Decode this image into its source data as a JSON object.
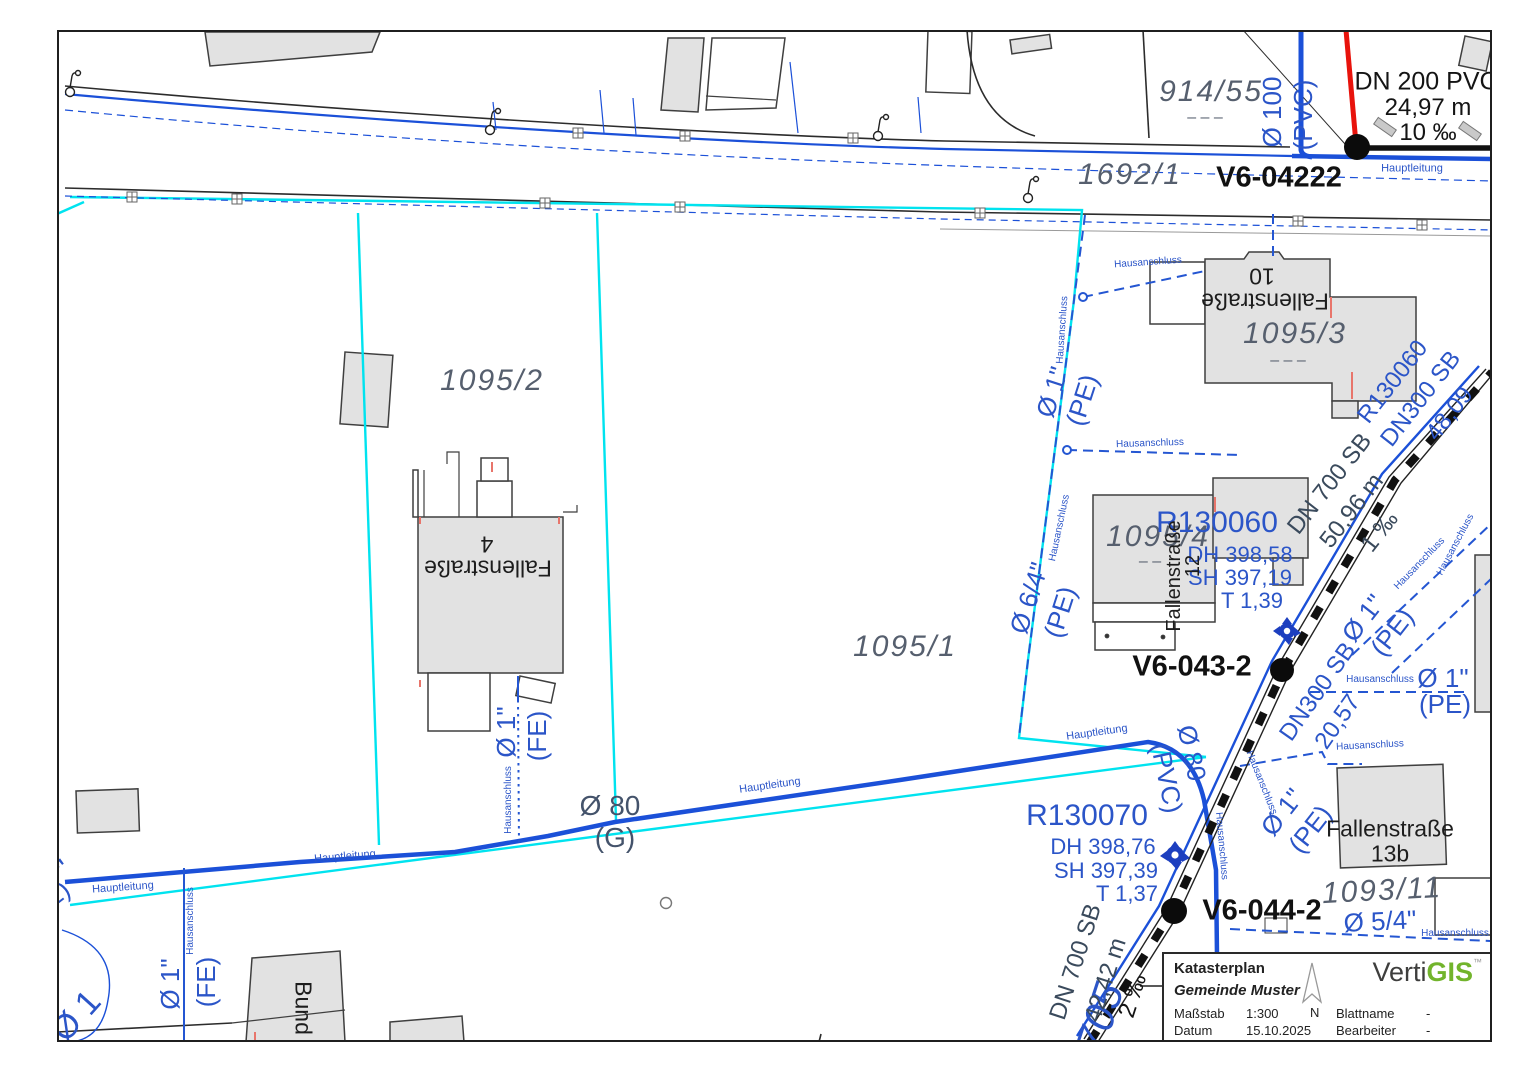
{
  "colors": {
    "water_blue": "#1b50d8",
    "label_blue": "#2b55c8",
    "boundary_cyan": "#00e3ef",
    "parcel_gray": "#565f6e",
    "sewer_label": "#3a4a5c",
    "red_accent": "#e8130c",
    "building_fill": "#e2e2e2",
    "logo_green": "#72b42c"
  },
  "legend": {
    "title": "Katasterplan",
    "municipality": "Gemeinde Muster",
    "scale_label": "Maßstab",
    "scale_value": "1:300",
    "date_label": "Datum",
    "date_value": "15.10.2025",
    "sheet_label": "Blattname",
    "sheet_value": "-",
    "editor_label": "Bearbeiter",
    "editor_value": "-",
    "north_label": "N",
    "logo": {
      "part1": "Verti",
      "part2": "GIS",
      "tm": "™"
    }
  },
  "map": {
    "labels": [
      {
        "n": "parcel-914-55",
        "t": "914/55",
        "x": 1211,
        "y": 92,
        "s": 30,
        "c": "#565f6e",
        "i": 1,
        "sp": 2
      },
      {
        "n": "parcel-914-55-dashes",
        "t": "– – –",
        "x": 1205,
        "y": 118,
        "s": 16,
        "c": "#565f6e"
      },
      {
        "n": "parcel-1692-1",
        "t": "1692/1",
        "x": 1130,
        "y": 175,
        "s": 30,
        "c": "#565f6e",
        "i": 1,
        "sp": 2
      },
      {
        "n": "parcel-1095-2",
        "t": "1095/2",
        "x": 492,
        "y": 381,
        "s": 30,
        "c": "#565f6e",
        "i": 1,
        "sp": 2
      },
      {
        "n": "parcel-1095-1",
        "t": "1095/1",
        "x": 905,
        "y": 647,
        "s": 30,
        "c": "#565f6e",
        "i": 1,
        "sp": 2
      },
      {
        "n": "parcel-1095-3",
        "t": "1095/3",
        "x": 1295,
        "y": 334,
        "s": 30,
        "c": "#565f6e",
        "i": 1,
        "sp": 2
      },
      {
        "n": "parcel-1095-3-dashes",
        "t": "– – –",
        "x": 1288,
        "y": 361,
        "s": 16,
        "c": "#565f6e"
      },
      {
        "n": "parcel-1095-4",
        "t": "1095/4",
        "x": 1158,
        "y": 537,
        "s": 30,
        "c": "#565f6e",
        "i": 1,
        "sp": 2
      },
      {
        "n": "parcel-1095-4-dash",
        "t": "– –",
        "x": 1150,
        "y": 562,
        "s": 16,
        "c": "#565f6e"
      },
      {
        "n": "parcel-1093-11",
        "t": "1093/11",
        "x": 1382,
        "y": 891,
        "s": 30,
        "c": "#565f6e",
        "i": 1,
        "sp": 2,
        "r": -3
      },
      {
        "n": "parcel-705",
        "t": "705",
        "x": 1100,
        "y": 1018,
        "s": 42,
        "c": "#2b55c8",
        "i": 1,
        "r": -72
      },
      {
        "n": "node-v6-04222",
        "t": "V6-04222",
        "x": 1279,
        "y": 178,
        "s": 29,
        "c": "#111111",
        "b": 1
      },
      {
        "n": "node-v6-043-2",
        "t": "V6-043-2",
        "x": 1192,
        "y": 667,
        "s": 29,
        "c": "#111111",
        "b": 1
      },
      {
        "n": "node-v6-044-2",
        "t": "V6-044-2",
        "x": 1262,
        "y": 911,
        "s": 29,
        "c": "#111111",
        "b": 1
      },
      {
        "n": "pipe-dn200-material",
        "t": "DN 200 PVC",
        "x": 1426,
        "y": 82,
        "s": 25,
        "c": "#141414"
      },
      {
        "n": "pipe-dn200-length",
        "t": "24,97 m",
        "x": 1428,
        "y": 108,
        "s": 24,
        "c": "#141414"
      },
      {
        "n": "pipe-dn200-slope",
        "t": "10 ‰",
        "x": 1428,
        "y": 133,
        "s": 24,
        "c": "#141414"
      },
      {
        "n": "hauptleitung-top",
        "t": "Hauptleitung",
        "x": 1412,
        "y": 169,
        "s": 11,
        "c": "#2b55c8"
      },
      {
        "n": "pipe-dia-100",
        "t": "Ø 100",
        "x": 1272,
        "y": 112,
        "s": 26,
        "c": "#2b55c8",
        "r": -90
      },
      {
        "n": "pipe-dia-100-mat",
        "t": "(PVC)",
        "x": 1303,
        "y": 115,
        "s": 26,
        "c": "#2b55c8",
        "r": -90
      },
      {
        "n": "shaft-r130060",
        "t": "R130060",
        "x": 1217,
        "y": 523,
        "s": 30,
        "c": "#2b55c8"
      },
      {
        "n": "shaft-r130060-dh",
        "t": "DH 398,58",
        "x": 1240,
        "y": 555,
        "s": 22,
        "c": "#2b55c8"
      },
      {
        "n": "shaft-r130060-sh",
        "t": "SH 397,19",
        "x": 1240,
        "y": 578,
        "s": 22,
        "c": "#2b55c8"
      },
      {
        "n": "shaft-r130060-t",
        "t": "T 1,39",
        "x": 1252,
        "y": 601,
        "s": 22,
        "c": "#2b55c8"
      },
      {
        "n": "shaft-r130070",
        "t": "R130070",
        "x": 1087,
        "y": 816,
        "s": 30,
        "c": "#2b55c8"
      },
      {
        "n": "shaft-r130070-dh",
        "t": "DH 398,76",
        "x": 1103,
        "y": 847,
        "s": 22,
        "c": "#2b55c8"
      },
      {
        "n": "shaft-r130070-sh",
        "t": "SH 397,39",
        "x": 1106,
        "y": 871,
        "s": 22,
        "c": "#2b55c8"
      },
      {
        "n": "shaft-r130070-t",
        "t": "T 1,37",
        "x": 1127,
        "y": 894,
        "s": 22,
        "c": "#2b55c8"
      },
      {
        "n": "sewer-dn700-upper",
        "t": "DN 700 SB",
        "x": 1330,
        "y": 484,
        "s": 24,
        "c": "#3a4a5c",
        "r": -52
      },
      {
        "n": "sewer-dn700-upper-length",
        "t": "50,96 m",
        "x": 1352,
        "y": 511,
        "s": 24,
        "c": "#3a4a5c",
        "r": -52
      },
      {
        "n": "sewer-dn700-upper-slope",
        "t": "1 ‰",
        "x": 1380,
        "y": 532,
        "s": 24,
        "c": "#3a4a5c",
        "r": -52
      },
      {
        "n": "water-r130060-rot",
        "t": "R130060",
        "x": 1393,
        "y": 382,
        "s": 24,
        "c": "#2b55c8",
        "r": -52
      },
      {
        "n": "water-dn300-upper",
        "t": "DN300 SB",
        "x": 1421,
        "y": 399,
        "s": 24,
        "c": "#2b55c8",
        "r": -52
      },
      {
        "n": "water-dn300-upper-length",
        "t": "48,09",
        "x": 1450,
        "y": 414,
        "s": 24,
        "c": "#2b55c8",
        "r": -52
      },
      {
        "n": "water-dn300-lower",
        "t": "DN300 SB",
        "x": 1318,
        "y": 692,
        "s": 24,
        "c": "#2b55c8",
        "r": -55
      },
      {
        "n": "water-dn300-lower-length",
        "t": "20,57",
        "x": 1338,
        "y": 722,
        "s": 24,
        "c": "#2b55c8",
        "r": -55
      },
      {
        "n": "sewer-dn700-lower",
        "t": "DN 700 SB",
        "x": 1076,
        "y": 962,
        "s": 24,
        "c": "#3a4a5c",
        "r": -72
      },
      {
        "n": "sewer-dn700-lower-length",
        "t": "42,42 m",
        "x": 1106,
        "y": 980,
        "s": 24,
        "c": "#3a4a5c",
        "r": -72
      },
      {
        "n": "sewer-dn700-lower-slope",
        "t": "2 ‰",
        "x": 1133,
        "y": 996,
        "s": 24,
        "c": "#141414",
        "r": -72
      },
      {
        "n": "pipe-dia-80-g",
        "t": "Ø 80",
        "x": 610,
        "y": 806,
        "s": 28,
        "c": "#44536b"
      },
      {
        "n": "pipe-dia-80-g-mat",
        "t": "(G)",
        "x": 615,
        "y": 838,
        "s": 28,
        "c": "#44536b"
      },
      {
        "n": "service-dia1-fe-mid",
        "t": "Ø 1\"",
        "x": 506,
        "y": 732,
        "s": 26,
        "c": "#2b55c8",
        "r": -90
      },
      {
        "n": "service-dia1-fe-mid-mat",
        "t": "(FE)",
        "x": 537,
        "y": 736,
        "s": 26,
        "c": "#2b55c8",
        "r": -90
      },
      {
        "n": "hausanschluss-mid",
        "t": "Hausanschluss",
        "x": 509,
        "y": 800,
        "s": 10,
        "c": "#2b55c8",
        "r": -90
      },
      {
        "n": "service-dia1-fe-left",
        "t": "Ø 1\"",
        "x": 170,
        "y": 984,
        "s": 26,
        "c": "#2b55c8",
        "r": -90
      },
      {
        "n": "service-dia1-fe-left-mat",
        "t": "(FE)",
        "x": 206,
        "y": 982,
        "s": 26,
        "c": "#2b55c8",
        "r": -90
      },
      {
        "n": "hausanschluss-left",
        "t": "Hausanschluss",
        "x": 191,
        "y": 921,
        "s": 10,
        "c": "#2b55c8",
        "r": -90
      },
      {
        "n": "hauptleitung-left",
        "t": "Hauptleitung",
        "x": 123,
        "y": 888,
        "s": 11,
        "c": "#2b55c8",
        "r": -4
      },
      {
        "n": "hauptleitung-left2",
        "t": "Hauptleitung",
        "x": 345,
        "y": 857,
        "s": 11,
        "c": "#2b55c8",
        "r": -5
      },
      {
        "n": "hauptleitung-mid",
        "t": "Hauptleitung",
        "x": 770,
        "y": 786,
        "s": 11,
        "c": "#2b55c8",
        "r": -8
      },
      {
        "n": "hauptleitung-right",
        "t": "Hauptleitung",
        "x": 1097,
        "y": 733,
        "s": 11,
        "c": "#2b55c8",
        "r": -8
      },
      {
        "n": "service-dia1-pe-top",
        "t": "Ø 1\"",
        "x": 1052,
        "y": 392,
        "s": 26,
        "c": "#2b55c8",
        "r": -72
      },
      {
        "n": "service-dia1-pe-top-mat",
        "t": "(PE)",
        "x": 1082,
        "y": 400,
        "s": 26,
        "c": "#2b55c8",
        "r": -72
      },
      {
        "n": "service-dia64-pe",
        "t": "Ø 6/4\"",
        "x": 1029,
        "y": 598,
        "s": 26,
        "c": "#2b55c8",
        "r": -72
      },
      {
        "n": "service-dia64-pe-mat",
        "t": "(PE)",
        "x": 1060,
        "y": 612,
        "s": 26,
        "c": "#2b55c8",
        "r": -72
      },
      {
        "n": "hausanschluss-cyan-top",
        "t": "Hausanschluss",
        "x": 1063,
        "y": 330,
        "s": 10,
        "c": "#2b55c8",
        "r": -86
      },
      {
        "n": "hausanschluss-cyan-mid",
        "t": "Hausanschluss",
        "x": 1060,
        "y": 528,
        "s": 10,
        "c": "#2b55c8",
        "r": -78
      },
      {
        "n": "hausanschluss-branch1",
        "t": "Hausanschluss",
        "x": 1148,
        "y": 263,
        "s": 10,
        "c": "#2b55c8",
        "r": -4
      },
      {
        "n": "hausanschluss-branch2",
        "t": "Hausanschluss",
        "x": 1150,
        "y": 444,
        "s": 10,
        "c": "#2b55c8",
        "r": -2
      },
      {
        "n": "service-dia1-pe-right1",
        "t": "Ø 1\"",
        "x": 1363,
        "y": 618,
        "s": 26,
        "c": "#2b55c8",
        "r": -52
      },
      {
        "n": "service-dia1-pe-right1-mat",
        "t": "(PE)",
        "x": 1392,
        "y": 632,
        "s": 26,
        "c": "#2b55c8",
        "r": -52
      },
      {
        "n": "hausanschluss-diag1",
        "t": "Hausanschluss",
        "x": 1420,
        "y": 564,
        "s": 10,
        "c": "#2b55c8",
        "r": -46
      },
      {
        "n": "hausanschluss-diag2",
        "t": "Hausanschluss",
        "x": 1456,
        "y": 545,
        "s": 10,
        "c": "#2b55c8",
        "r": -62
      },
      {
        "n": "hausanschluss-right-row",
        "t": "Hausanschluss",
        "x": 1380,
        "y": 680,
        "s": 10,
        "c": "#2b55c8"
      },
      {
        "n": "service-dia1-pe-right2",
        "t": "Ø 1\"",
        "x": 1443,
        "y": 678,
        "s": 26,
        "c": "#2b55c8"
      },
      {
        "n": "service-dia1-pe-right2-mat",
        "t": "(PE)",
        "x": 1445,
        "y": 704,
        "s": 26,
        "c": "#2b55c8"
      },
      {
        "n": "hausanschluss-13b",
        "t": "Hausanschluss",
        "x": 1370,
        "y": 746,
        "s": 10,
        "c": "#2b55c8",
        "r": -3
      },
      {
        "n": "pipe-dia-80-pvc",
        "t": "Ø 80",
        "x": 1192,
        "y": 753,
        "s": 26,
        "c": "#2b55c8",
        "r": 78
      },
      {
        "n": "pipe-dia-80-pvc-mat",
        "t": "(PVC)",
        "x": 1167,
        "y": 778,
        "s": 26,
        "c": "#2b55c8",
        "r": 78
      },
      {
        "n": "hausanschluss-v644a",
        "t": "Hausanschluss",
        "x": 1221,
        "y": 846,
        "s": 10,
        "c": "#2b55c8",
        "r": 85
      },
      {
        "n": "hausanschluss-v644b",
        "t": "Hausanschluss",
        "x": 1261,
        "y": 783,
        "s": 10,
        "c": "#2b55c8",
        "r": 68
      },
      {
        "n": "service-dia1-pe-v644",
        "t": "Ø 1\"",
        "x": 1282,
        "y": 812,
        "s": 26,
        "c": "#2b55c8",
        "r": -52
      },
      {
        "n": "service-dia1-pe-v644-mat",
        "t": "(PE)",
        "x": 1310,
        "y": 829,
        "s": 26,
        "c": "#2b55c8",
        "r": -52
      },
      {
        "n": "service-dia54",
        "t": "Ø 5/4\"",
        "x": 1380,
        "y": 921,
        "s": 26,
        "c": "#2b55c8",
        "r": -3
      },
      {
        "n": "hausanschluss-bottom-right",
        "t": "Hausanschluss",
        "x": 1455,
        "y": 934,
        "s": 10,
        "c": "#2b55c8"
      },
      {
        "n": "bldg-f10-name",
        "t": "Fallenstraße",
        "x": 1265,
        "y": 301,
        "s": 23,
        "c": "#1d1d1d",
        "r": 180
      },
      {
        "n": "bldg-f10-no",
        "t": "10",
        "x": 1262,
        "y": 276,
        "s": 23,
        "c": "#1d1d1d",
        "r": 180
      },
      {
        "n": "bldg-f4-name",
        "t": "Fallenstraße",
        "x": 488,
        "y": 568,
        "s": 23,
        "c": "#1d1d1d",
        "r": 180
      },
      {
        "n": "bldg-f4-no",
        "t": "4",
        "x": 487,
        "y": 544,
        "s": 23,
        "c": "#1d1d1d",
        "r": 180
      },
      {
        "n": "bldg-f12-name",
        "t": "Fallenstraße",
        "x": 1174,
        "y": 576,
        "s": 20,
        "c": "#1d1d1d",
        "r": -90
      },
      {
        "n": "bldg-f12-no",
        "t": "12",
        "x": 1193,
        "y": 566,
        "s": 20,
        "c": "#1d1d1d",
        "r": -90
      },
      {
        "n": "bldg-f13b-name",
        "t": "Fallenstraße",
        "x": 1390,
        "y": 829,
        "s": 23,
        "c": "#1d1d1d"
      },
      {
        "n": "bldg-f13b-no",
        "t": "13b",
        "x": 1390,
        "y": 854,
        "s": 23,
        "c": "#1d1d1d"
      },
      {
        "n": "bldg-bund",
        "t": "Bund",
        "x": 303,
        "y": 1008,
        "s": 23,
        "c": "#1d1d1d",
        "r": 90
      },
      {
        "n": "clip-pe-left",
        "t": "(PE)",
        "x": 46,
        "y": 902,
        "s": 26,
        "c": "#2b55c8",
        "r": -38
      },
      {
        "n": "clip-quote-left",
        "t": "\"",
        "x": 64,
        "y": 870,
        "s": 30,
        "c": "#2b55c8",
        "r": -38
      },
      {
        "n": "clip-dia1-left",
        "t": "Ø 1",
        "x": 76,
        "y": 1016,
        "s": 34,
        "c": "#2b55c8",
        "r": -48
      }
    ]
  }
}
